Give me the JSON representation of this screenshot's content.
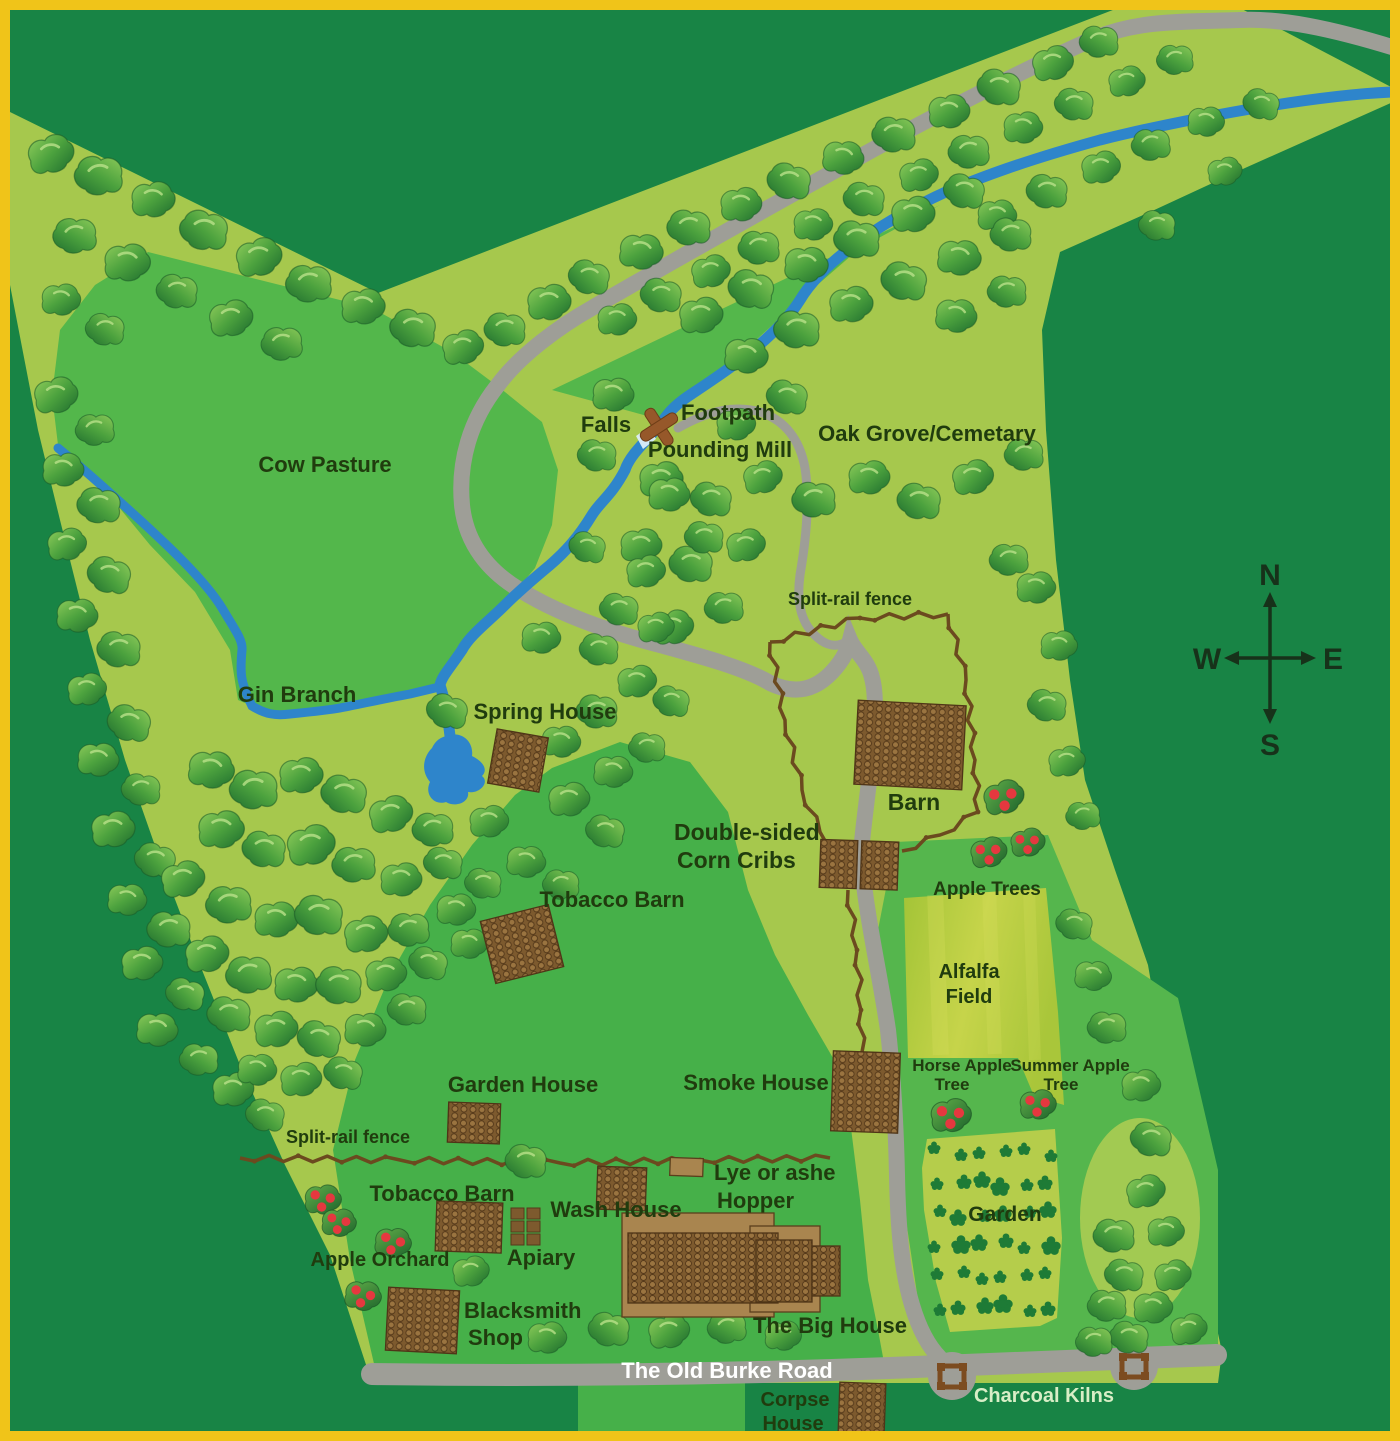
{
  "map": {
    "labels": [
      {
        "id": "cow-pasture",
        "text": "Cow Pasture",
        "x": 325,
        "y": 472,
        "size": 22
      },
      {
        "id": "gin-branch",
        "text": "Gin Branch",
        "x": 297,
        "y": 702,
        "size": 22
      },
      {
        "id": "falls",
        "text": "Falls",
        "x": 606,
        "y": 432,
        "size": 22
      },
      {
        "id": "footpath",
        "text": "Footpath",
        "x": 728,
        "y": 420,
        "size": 22
      },
      {
        "id": "pounding-mill",
        "text": "Pounding Mill",
        "x": 720,
        "y": 457,
        "size": 22
      },
      {
        "id": "oak-grove-cemetary",
        "text": "Oak Grove/Cemetary",
        "x": 927,
        "y": 441,
        "size": 22
      },
      {
        "id": "spring-house",
        "text": "Spring House",
        "x": 545,
        "y": 719,
        "size": 22
      },
      {
        "id": "split-rail-fence-north",
        "text": "Split-rail fence",
        "x": 850,
        "y": 605,
        "size": 18
      },
      {
        "id": "barn",
        "text": "Barn",
        "x": 914,
        "y": 810,
        "size": 23
      },
      {
        "id": "corn-cribs-line1",
        "text": "Double-sided",
        "x": 674,
        "y": 840,
        "size": 23,
        "anchor": "start"
      },
      {
        "id": "corn-cribs-line2",
        "text": "Corn Cribs",
        "x": 677,
        "y": 868,
        "size": 23,
        "anchor": "start"
      },
      {
        "id": "apple-trees",
        "text": "Apple Trees",
        "x": 987,
        "y": 895,
        "size": 19
      },
      {
        "id": "tobacco-barn-north",
        "text": "Tobacco Barn",
        "x": 612,
        "y": 907,
        "size": 22
      },
      {
        "id": "alfalfa-line1",
        "text": "Alfalfa",
        "x": 969,
        "y": 978,
        "size": 20
      },
      {
        "id": "alfalfa-line2",
        "text": "Field",
        "x": 969,
        "y": 1003,
        "size": 20
      },
      {
        "id": "garden-house",
        "text": "Garden House",
        "x": 523,
        "y": 1092,
        "size": 22
      },
      {
        "id": "smoke-house",
        "text": "Smoke House",
        "x": 756,
        "y": 1090,
        "size": 22
      },
      {
        "id": "split-rail-fence-west",
        "text": "Split-rail fence",
        "x": 348,
        "y": 1143,
        "size": 18
      },
      {
        "id": "horse-apple-line1",
        "text": "Horse Apple",
        "x": 962,
        "y": 1071,
        "size": 17
      },
      {
        "id": "horse-apple-line2",
        "text": "Tree",
        "x": 952,
        "y": 1090,
        "size": 17
      },
      {
        "id": "summer-apple-line1",
        "text": "Summer Apple",
        "x": 1070,
        "y": 1071,
        "size": 17
      },
      {
        "id": "summer-apple-line2",
        "text": "Tree",
        "x": 1061,
        "y": 1090,
        "size": 17
      },
      {
        "id": "lye-hopper-line1",
        "text": "Lye or ashe",
        "x": 714,
        "y": 1180,
        "size": 22,
        "anchor": "start"
      },
      {
        "id": "lye-hopper-line2",
        "text": "Hopper",
        "x": 717,
        "y": 1208,
        "size": 22,
        "anchor": "start"
      },
      {
        "id": "tobacco-barn-south",
        "text": "Tobacco Barn",
        "x": 442,
        "y": 1201,
        "size": 22
      },
      {
        "id": "wash-house",
        "text": "Wash House",
        "x": 616,
        "y": 1217,
        "size": 22
      },
      {
        "id": "apiary",
        "text": "Apiary",
        "x": 541,
        "y": 1265,
        "size": 22
      },
      {
        "id": "apple-orchard",
        "text": "Apple Orchard",
        "x": 380,
        "y": 1266,
        "size": 20
      },
      {
        "id": "blacksmith-line1",
        "text": "Blacksmith",
        "x": 464,
        "y": 1318,
        "size": 22,
        "anchor": "start"
      },
      {
        "id": "blacksmith-line2",
        "text": "Shop",
        "x": 468,
        "y": 1345,
        "size": 22,
        "anchor": "start"
      },
      {
        "id": "big-house",
        "text": "The Big House",
        "x": 830,
        "y": 1333,
        "size": 22
      },
      {
        "id": "garden",
        "text": "Garden",
        "x": 1005,
        "y": 1221,
        "size": 21
      },
      {
        "id": "old-burke-road",
        "text": "The Old Burke Road",
        "x": 727,
        "y": 1378,
        "size": 22,
        "color": "#ffffff"
      },
      {
        "id": "corpse-house-line1",
        "text": "Corpse",
        "x": 795,
        "y": 1406,
        "size": 20
      },
      {
        "id": "corpse-house-line2",
        "text": "House",
        "x": 793,
        "y": 1430,
        "size": 20
      },
      {
        "id": "charcoal-kilns",
        "text": "Charcoal Kilns",
        "x": 1044,
        "y": 1402,
        "size": 20,
        "color": "#d8eec6"
      }
    ],
    "compass": {
      "north": "N",
      "south": "S",
      "east": "E",
      "west": "W"
    },
    "colors": {
      "background_forest": "#188445",
      "cleared_land": "#a6c84d",
      "pasture": "#53b74b",
      "homestead": "#46b049",
      "road": "#9e9e97",
      "stream": "#2e85cb",
      "fence": "#6b4a1f",
      "building": "#7d5a2e",
      "label_text": "#203c0e",
      "frame_border": "#f0c419",
      "apple_red": "#e5383f",
      "garden_plant": "#1e7b36",
      "alfalfa": "#b8cc3e"
    }
  }
}
